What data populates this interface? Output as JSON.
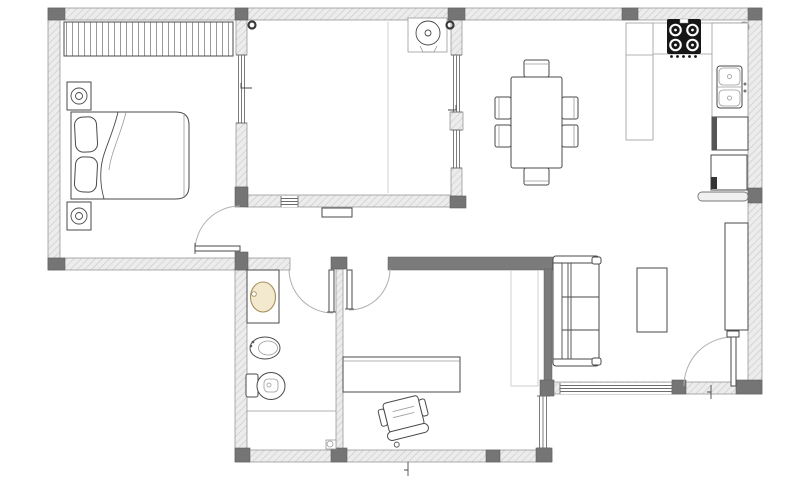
{
  "image": {
    "kind": "architectural-floor-plan",
    "width": 800,
    "height": 500,
    "background": "#ffffff",
    "visible_text": "none"
  },
  "palette": {
    "bg": "#ffffff",
    "wall_fill": "#ececec",
    "wall_hatch": "#c6c6c6",
    "wall_stroke": "#8a8a8a",
    "column_fill": "#757575",
    "partition_fill": "#7b7b7b",
    "line": "#4a4a4a",
    "thin": "#9a9a9a",
    "faint": "#cccccc",
    "door_arc": "#b0b0b0",
    "stove_fill": "#161616",
    "basin_fill": "#f3e9ce",
    "basin_stroke": "#a5905f"
  },
  "plan": {
    "footprint": "L-shaped apartment; upper band x48-762 y8-270; lower extension x235-552 y270-462; living wing extends to y395 on right",
    "rooms": [
      {
        "name": "bedroom",
        "bbox": [
          60,
          20,
          177,
          238
        ]
      },
      {
        "name": "secondary-room",
        "bbox": [
          248,
          20,
          202,
          175
        ]
      },
      {
        "name": "hallway",
        "bbox": [
          248,
          207,
          214,
          50
        ]
      },
      {
        "name": "bathroom",
        "bbox": [
          247,
          270,
          89,
          180
        ]
      },
      {
        "name": "study",
        "bbox": [
          343,
          270,
          201,
          180
        ]
      },
      {
        "name": "living-dining-kitchen",
        "bbox": [
          465,
          20,
          283,
          360
        ]
      }
    ],
    "walls": {
      "exterior_hatched": [
        [
          48,
          8,
          714,
          12
        ],
        [
          48,
          20,
          12,
          250
        ],
        [
          48,
          258,
          242,
          12
        ],
        [
          235,
          270,
          12,
          180
        ],
        [
          235,
          450,
          317,
          12
        ],
        [
          748,
          20,
          14,
          362
        ],
        [
          552,
          382,
          210,
          12
        ],
        [
          246,
          195,
          216,
          12
        ],
        [
          336,
          269,
          7,
          181
        ]
      ],
      "partitions_new": [
        [
          388,
          257,
          165,
          13
        ],
        [
          544,
          269,
          8,
          113
        ]
      ],
      "columns": [
        [
          48,
          8,
          17,
          12
        ],
        [
          235,
          8,
          13,
          12
        ],
        [
          448,
          8,
          17,
          12
        ],
        [
          622,
          8,
          16,
          12
        ],
        [
          748,
          8,
          14,
          12
        ],
        [
          48,
          258,
          17,
          12
        ],
        [
          235,
          252,
          13,
          18
        ],
        [
          235,
          187,
          13,
          20
        ],
        [
          450,
          196,
          16,
          12
        ],
        [
          331,
          257,
          16,
          12
        ],
        [
          331,
          448,
          16,
          14
        ],
        [
          235,
          448,
          15,
          14
        ],
        [
          486,
          450,
          14,
          12
        ],
        [
          536,
          448,
          16,
          14
        ],
        [
          540,
          380,
          14,
          16
        ],
        [
          672,
          380,
          14,
          14
        ],
        [
          736,
          380,
          26,
          14
        ],
        [
          748,
          188,
          14,
          15
        ]
      ]
    },
    "windows": [
      {
        "id": "bedroom-partition-window",
        "bbox": [
          236,
          55,
          11,
          68
        ]
      },
      {
        "id": "secondary-room-window-upper",
        "bbox": [
          451,
          55,
          11,
          57
        ]
      },
      {
        "id": "secondary-room-window-lower",
        "bbox": [
          451,
          130,
          11,
          38
        ]
      },
      {
        "id": "secondary-room-south-window",
        "bbox": [
          281,
          196,
          17,
          11
        ]
      },
      {
        "id": "study-east-window",
        "bbox": [
          537,
          396,
          13,
          52
        ]
      },
      {
        "id": "living-south-window",
        "bbox": [
          560,
          383,
          112,
          11
        ]
      }
    ],
    "doors": [
      {
        "id": "bedroom-door",
        "hinge": [
          240,
          251
        ],
        "radius": 45,
        "swing": "into bedroom",
        "leaf": [
          195,
          246,
          45,
          5
        ]
      },
      {
        "id": "bathroom-door",
        "hinge": [
          333,
          269
        ],
        "radius": 44,
        "swing": "into bathroom",
        "leaf": [
          329,
          270,
          5,
          42
        ]
      },
      {
        "id": "study-door",
        "hinge": [
          349,
          269
        ],
        "radius": 41,
        "swing": "into study",
        "leaf": [
          347,
          270,
          5,
          39
        ]
      },
      {
        "id": "entry-door",
        "hinge": [
          733,
          386
        ],
        "radius": 49,
        "swing": "into living room",
        "leaf": [
          731,
          337,
          5,
          49
        ]
      }
    ],
    "furniture": [
      {
        "name": "wardrobe",
        "room": "bedroom",
        "bbox": [
          64,
          22,
          169,
          34
        ],
        "style": "vertical-stripes"
      },
      {
        "name": "nightstand-upper",
        "room": "bedroom",
        "bbox": [
          67,
          82,
          24,
          28
        ],
        "detail": "double-circle lamp"
      },
      {
        "name": "nightstand-lower",
        "room": "bedroom",
        "bbox": [
          67,
          202,
          24,
          28
        ],
        "detail": "double-circle lamp"
      },
      {
        "name": "double-bed",
        "room": "bedroom",
        "bbox": [
          71,
          112,
          118,
          87
        ],
        "pillows": 2
      },
      {
        "name": "washing-machine",
        "room": "secondary-room",
        "bbox": [
          408,
          18,
          39,
          34
        ],
        "detail": "round drum top view"
      },
      {
        "name": "radiator",
        "room": "hallway",
        "bbox": [
          322,
          208,
          30,
          9
        ]
      },
      {
        "name": "dining-table",
        "room": "living-dining-kitchen",
        "bbox": [
          511,
          77,
          51,
          91
        ],
        "chairs": 6
      },
      {
        "name": "sofa",
        "room": "living-dining-kitchen",
        "bbox": [
          553,
          256,
          46,
          110
        ],
        "cushions": 3
      },
      {
        "name": "coffee-table",
        "room": "living-dining-kitchen",
        "bbox": [
          637,
          268,
          30,
          64
        ]
      },
      {
        "name": "sideboard",
        "room": "living-dining-kitchen",
        "bbox": [
          725,
          223,
          23,
          107
        ]
      },
      {
        "name": "desk",
        "room": "study",
        "bbox": [
          343,
          357,
          117,
          35
        ]
      },
      {
        "name": "office-chair",
        "room": "study",
        "bbox": [
          380,
          397,
          48,
          46
        ],
        "rotation_deg": -14
      }
    ],
    "kitchen": {
      "counter_peninsula": [
        626,
        23,
        27,
        117
      ],
      "counter_right_strip": [
        712,
        23,
        36,
        94
      ],
      "cooktop": {
        "bbox": [
          667,
          19,
          34,
          35
        ],
        "burners": 4,
        "knobs": 5,
        "color": "#161616"
      },
      "sink": {
        "bbox": [
          717,
          66,
          25,
          42
        ],
        "basins": 2
      },
      "built-in-appliance-upper": [
        712,
        117,
        36,
        33
      ],
      "built-in-appliance-lower": [
        711,
        155,
        36,
        35
      ],
      "breakfast-bar": [
        698,
        192,
        50,
        9
      ],
      "corner-round-fixture": {
        "center": [
          744,
          27
        ],
        "r": 5
      }
    },
    "bathroom_fixtures": [
      {
        "name": "vanity-counter",
        "bbox": [
          247,
          270,
          32,
          53
        ]
      },
      {
        "name": "washbasin",
        "center": [
          263,
          297
        ],
        "rx": 12.5,
        "ry": 15,
        "fill": "#f3e9ce"
      },
      {
        "name": "bidet",
        "center": [
          265,
          348
        ],
        "rx": 15,
        "ry": 11
      },
      {
        "name": "toilet",
        "bbox": [
          246,
          372,
          39,
          27
        ]
      },
      {
        "name": "shower-divider-line",
        "from": [
          247,
          411
        ],
        "to": [
          336,
          411
        ]
      },
      {
        "name": "floor-drain",
        "bbox": [
          326,
          440,
          10,
          9
        ]
      }
    ],
    "misc": [
      {
        "name": "wall-hook-left",
        "center": [
          252,
          25
        ],
        "r": 3.5
      },
      {
        "name": "wall-hook-right",
        "center": [
          450,
          25
        ],
        "r": 3.5
      },
      {
        "name": "center-fold-line",
        "from": [
          388,
          22
        ],
        "to": [
          388,
          193
        ]
      },
      {
        "name": "shaft-outline-faint",
        "bbox": [
          511,
          270,
          27,
          116
        ]
      },
      {
        "name": "window-tick-left",
        "at": [
          241,
          88
        ]
      },
      {
        "name": "window-tick-right",
        "at": [
          457,
          110
        ]
      },
      {
        "name": "threshold-tick-south",
        "at": [
          408,
          462
        ]
      },
      {
        "name": "threshold-tick-entry",
        "at": [
          711,
          388
        ]
      }
    ]
  }
}
